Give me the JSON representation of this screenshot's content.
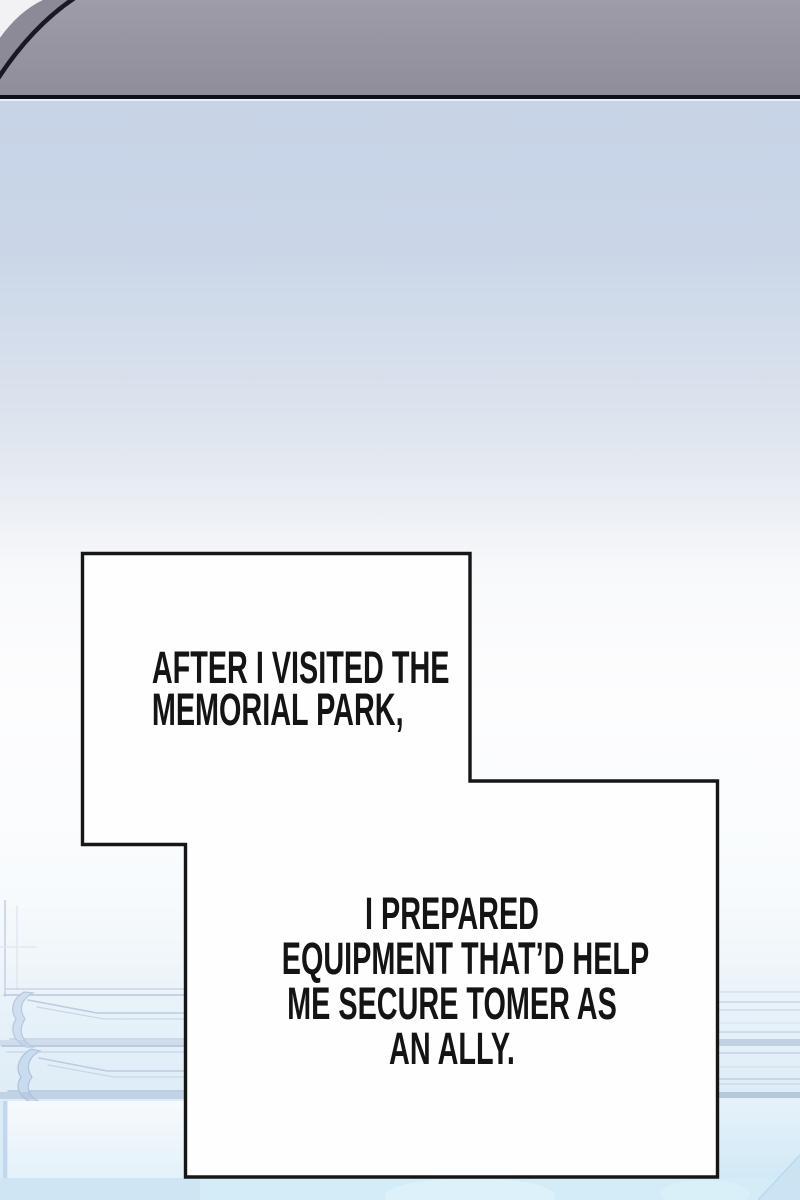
{
  "panel": {
    "type": "webtoon-comic-panel",
    "captions": [
      {
        "id": "caption-1",
        "lines": [
          "AFTER I VISITED THE",
          "MEMORIAL PARK,"
        ]
      },
      {
        "id": "caption-2",
        "lines": [
          "I PREPARED",
          "EQUIPMENT THAT’D HELP",
          "ME SECURE TOMER AS",
          "AN ALLY."
        ]
      }
    ],
    "colors": {
      "caption_ink": "#141414",
      "caption_border": "#161616",
      "caption_fill": "#fefefe",
      "top_panel_gray_top": "#9e9ca8",
      "top_panel_gray_bottom": "#8f8d99",
      "top_panel_outline": "#14141f",
      "top_corner_white": "#f2f1f3",
      "sky_blue_top": "#c7d3e6",
      "sky_white_mid": "#fdfdfe",
      "bottom_cyan": "#d6effa",
      "artwork_line_blue": "#b9c8dc"
    }
  }
}
